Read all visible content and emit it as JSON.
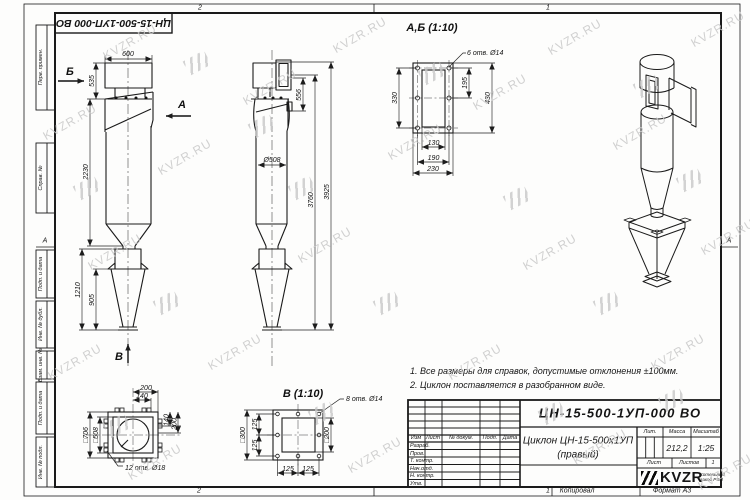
{
  "watermark": {
    "text": "KVZR.RU"
  },
  "frame": {
    "doc_number_top": "ЦН-15-500-1УП-000 ВО",
    "zone_top": [
      "2",
      "1"
    ],
    "zone_bottom": [
      "2",
      "1"
    ],
    "zone_left": "А",
    "zone_right": "А",
    "margin_labels": [
      "Перв. примен.",
      "Справ. №",
      "Подп. и дата",
      "Инв. № дубл.",
      "Взам. инв. №",
      "Подп. и дата",
      "Инв. № подл."
    ],
    "copied": "Копировал",
    "format": "Формат А3"
  },
  "views": {
    "front": {
      "dims": {
        "w600": "600",
        "h535": "535",
        "h2230": "2230",
        "h1210": "1210",
        "h905": "905"
      },
      "labels": {
        "a": "А",
        "b": "Б",
        "v": "В"
      }
    },
    "side": {
      "dims": {
        "d508": "Ø508",
        "h556": "556",
        "h3760": "3760",
        "h3925": "3925"
      }
    },
    "detail_ab": {
      "title": "А,Б (1:10)",
      "holes": "6 отв. Ø14",
      "dims": {
        "v330": "330",
        "v195": "195",
        "v430": "430",
        "b130": "130",
        "b190": "190",
        "b230": "230"
      }
    },
    "bottom": {
      "holes": "12 отв. Ø18",
      "dims": {
        "t200": "200",
        "t140": "140",
        "r140": "140",
        "r200": "200",
        "sq706": "□706",
        "sq508": "□508"
      }
    },
    "detail_v": {
      "title": "В (1:10)",
      "holes": "8 отв. Ø14",
      "dims": {
        "sq300": "□300",
        "l125a": "125",
        "l125b": "125",
        "sq200": "□200",
        "b125a": "125",
        "b125b": "125"
      }
    }
  },
  "notes": {
    "line1": "1. Все размеры для справок, допустимые отклонения ±100мм.",
    "line2": "2. Циклон поставляется в разобранном виде."
  },
  "title_block": {
    "doc_number": "ЦН-15-500-1УП-000 ВО",
    "name_line1": "Циклон ЦН-15-500х1УП",
    "name_line2": "(правый)",
    "cols": {
      "izm": "Изм",
      "list": "Лист",
      "doc": "№ докум.",
      "podp": "Подп.",
      "data": "Дата"
    },
    "rows": [
      "Разраб.",
      "Пров.",
      "Т. контр.",
      "Нач.отд.",
      "Н. контр.",
      "Утв."
    ],
    "lit": "Лит.",
    "mass": "Масса",
    "scale": "Масштаб",
    "mass_value": "212,2",
    "scale_value": "1:25",
    "sheet": "Лист",
    "sheets": "Листов",
    "sheets_value": "1",
    "logo": "KVZR",
    "logo_sub1": "Котельный",
    "logo_sub2": "завод РЭП"
  }
}
